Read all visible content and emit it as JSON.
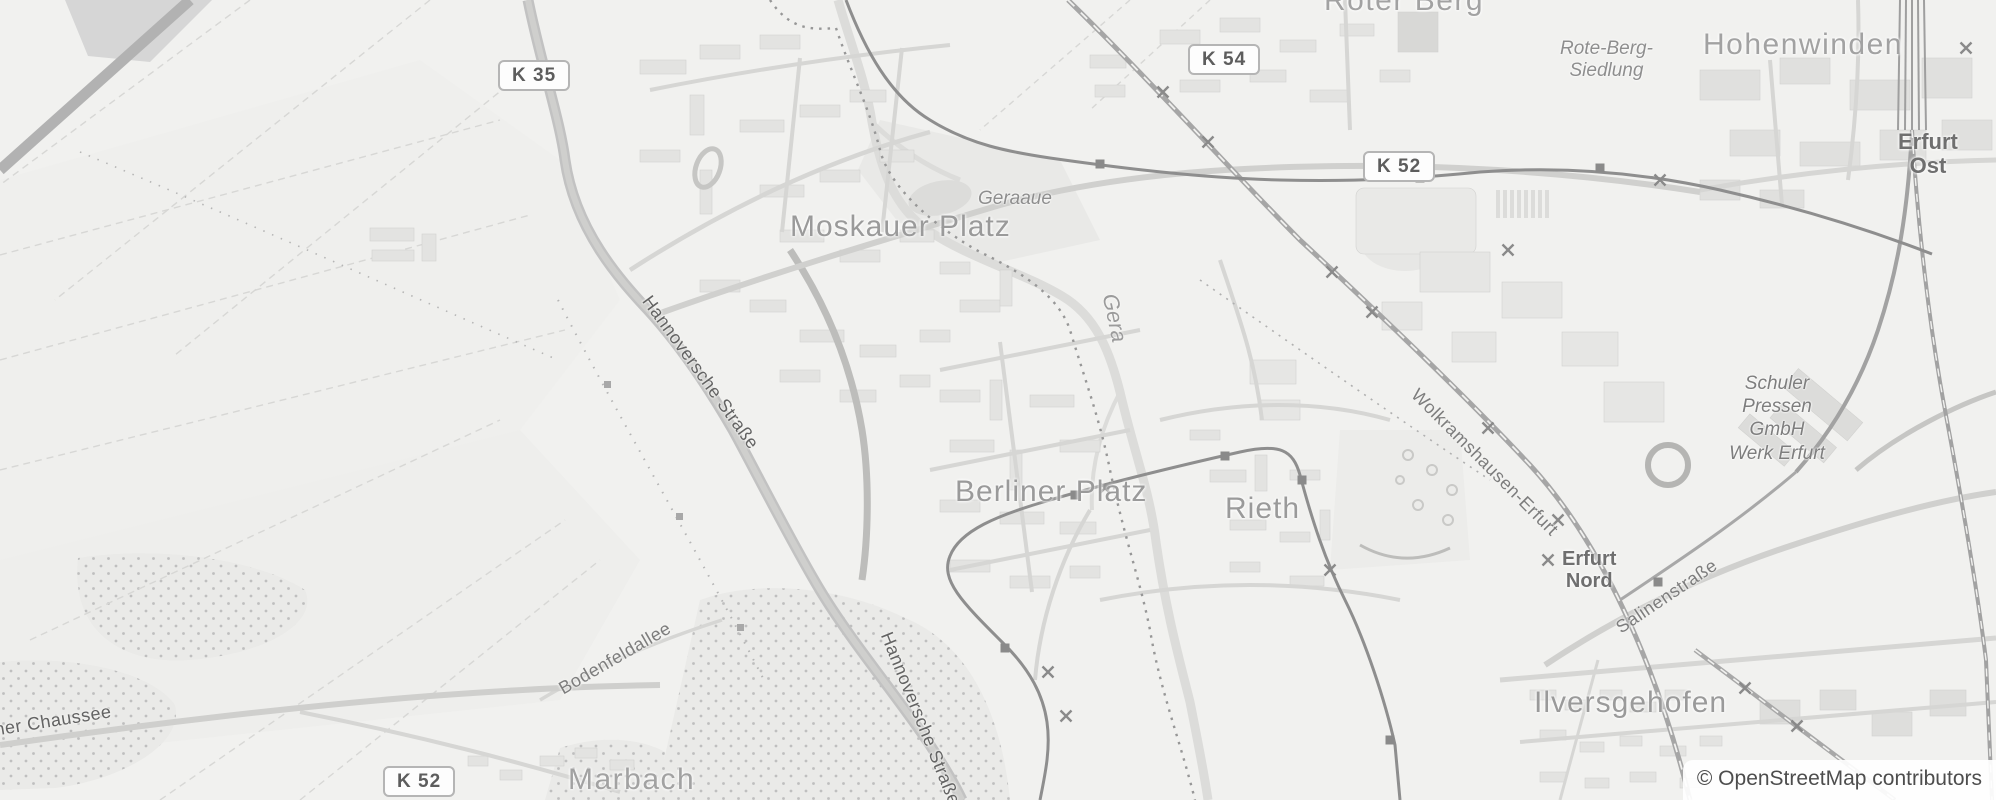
{
  "map": {
    "attribution": "© OpenStreetMap contributors",
    "badges": {
      "k35": "K 35",
      "k54": "K 54",
      "k52_north": "K 52",
      "k52_south": "K 52"
    },
    "places": {
      "roter_berg": "Roter Berg",
      "rote_berg_siedlung_line1": "Rote-Berg-",
      "rote_berg_siedlung_line2": "Siedlung",
      "hohenwinden": "Hohenwinden",
      "erfurt_ost_line1": "Erfurt",
      "erfurt_ost_line2": "Ost",
      "moskauer_platz": "Moskauer Platz",
      "geraaue": "Geraaue",
      "gera": "Gera",
      "berliner_platz": "Berliner Platz",
      "rieth": "Rieth",
      "erfurt_nord_line1": "Erfurt",
      "erfurt_nord_line2": "Nord",
      "ilversgehofen": "Ilversgehofen",
      "marbach": "Marbach",
      "schuler_line1": "Schuler",
      "schuler_line2": "Pressen",
      "schuler_line3": "GmbH",
      "schuler_line4": "Werk Erfurt"
    },
    "streets": {
      "hannoversche_nord": "Hannoversche Straße",
      "hannoversche_sued": "Hannoversche Straße",
      "bodenfeldallee": "Bodenfeldallee",
      "chaussee": "acher Chaussee",
      "salinenstrasse": "Salinenstraße",
      "wolkramshausen_erfurt": "Wolkramshausen-Erfurt"
    },
    "colors": {
      "background": "#f1f1ef",
      "place_label": "#9a9a9a",
      "road_major": "#c3c3c3",
      "railway": "#a6a6a6",
      "tram": "#8e8e8e",
      "badge_border": "#b5b5b5",
      "attribution_text": "#4d4d4d"
    }
  }
}
